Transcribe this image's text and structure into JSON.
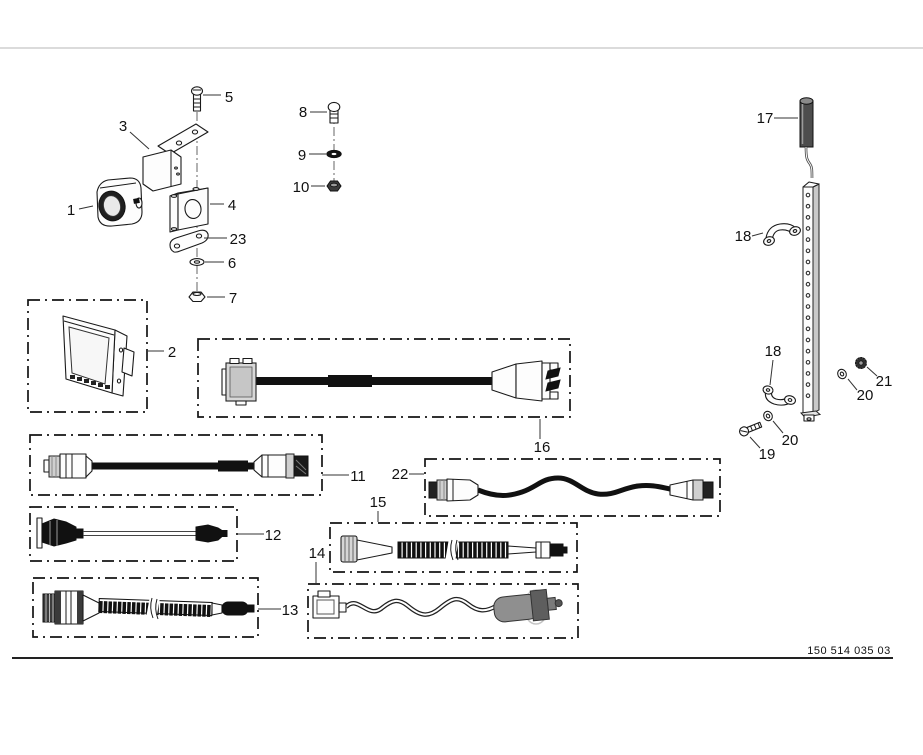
{
  "document": {
    "type": "exploded-parts-diagram",
    "footer": {
      "drawing_number": "150 514 035 03"
    },
    "colors": {
      "background": "#ffffff",
      "line": "#1a1a1a",
      "cable_fill": "#111111",
      "plug_gray": "#8f8f8f",
      "top_rule": "#cfcfcf",
      "footer_rule": "#222222"
    }
  },
  "callouts": {
    "c1": "1",
    "c2": "2",
    "c3": "3",
    "c4": "4",
    "c5": "5",
    "c6": "6",
    "c7": "7",
    "c8": "8",
    "c9": "9",
    "c10": "10",
    "c11": "11",
    "c12": "12",
    "c13": "13",
    "c14": "14",
    "c15": "15",
    "c16": "16",
    "c17": "17",
    "c18_upper": "18",
    "c18_lower": "18",
    "c19": "19",
    "c20_upper": "20",
    "c20_lower": "20",
    "c21": "21",
    "c22": "22",
    "c23": "23"
  },
  "parts": {
    "p1": "camera",
    "p2": "monitor",
    "p3": "mounting-bracket",
    "p4": "clamp-block",
    "p5": "screw",
    "p6": "washer",
    "p7": "nut",
    "p8": "screw",
    "p9": "washer",
    "p10": "nut",
    "p11": "cable",
    "p12": "cable",
    "p13": "cable",
    "p14": "power-cable",
    "p15": "cable",
    "p16": "monitor-cable",
    "p17": "antenna-rod",
    "p18": "clamp",
    "p19": "screw",
    "p20": "washer",
    "p21": "nut",
    "p22": "cable",
    "p23": "plate"
  }
}
